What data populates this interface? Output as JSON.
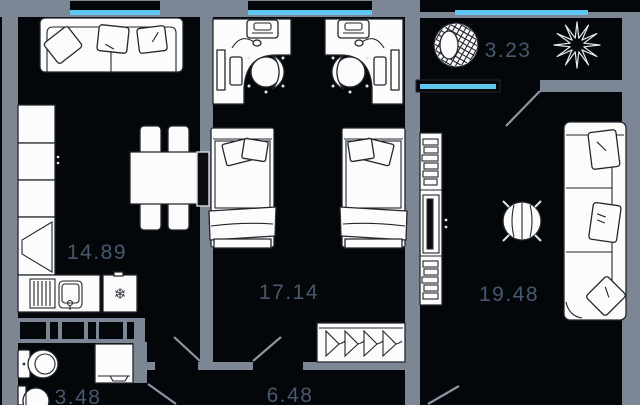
{
  "plan": {
    "title": "apartment-floor-plan",
    "rooms": {
      "kitchen_living": {
        "area": "14.89"
      },
      "kids_bedroom": {
        "area": "17.14"
      },
      "living_room": {
        "area": "19.48"
      },
      "balcony": {
        "area": "3.23"
      },
      "bathroom": {
        "area": "3.48"
      },
      "hallway": {
        "area": "6.48"
      }
    },
    "icons": {
      "fridge_snowflake": "❄"
    },
    "colors": {
      "background": "#04070a",
      "wall": "#7d8695",
      "glazing": "#5ec7ef",
      "label": "#47586f",
      "furniture_outline": "#23262c",
      "door_swing": "#8d95a4"
    }
  }
}
